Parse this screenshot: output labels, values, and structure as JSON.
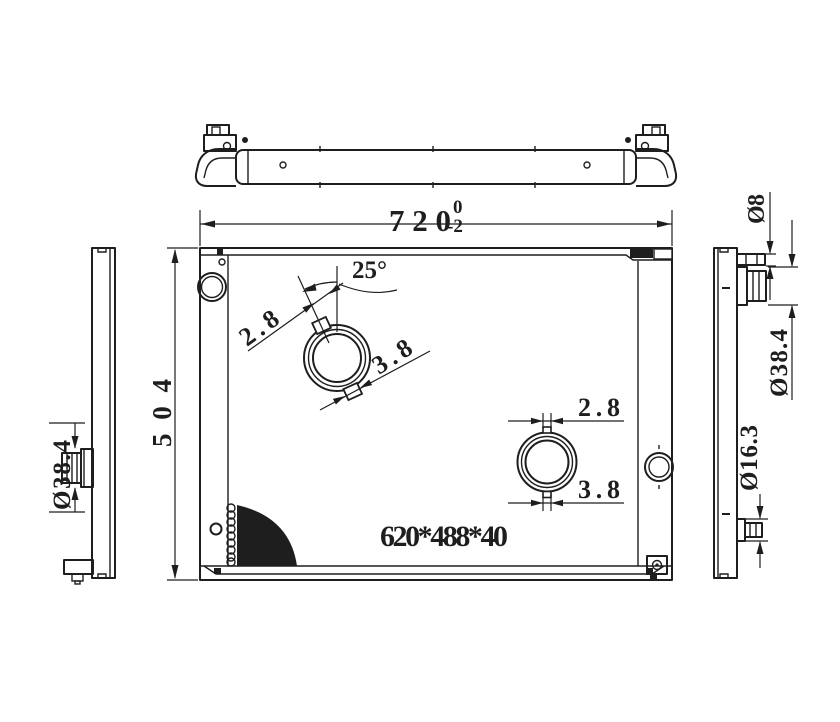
{
  "colors": {
    "line": "#1e1e1e",
    "background": "#ffffff"
  },
  "dimensions": {
    "overall_width": {
      "value": "720",
      "tolerance_upper": "0",
      "tolerance_lower": "-2"
    },
    "overall_height": {
      "value": "504"
    },
    "core_size": {
      "value": "620*488*40"
    },
    "neck_angle": {
      "value": "25°"
    },
    "neck1": {
      "width_a": "2.8",
      "width_b": "3.8"
    },
    "neck2": {
      "width_a": "2.8",
      "width_b": "3.8"
    },
    "left_outlet_diameter": {
      "value": "Ø38.4"
    },
    "right_inlet_small_diameter": {
      "value": "Ø8"
    },
    "right_inlet_flange_diameter": {
      "value": "Ø38.4"
    },
    "right_drain_diameter": {
      "value": "Ø16.3"
    }
  }
}
